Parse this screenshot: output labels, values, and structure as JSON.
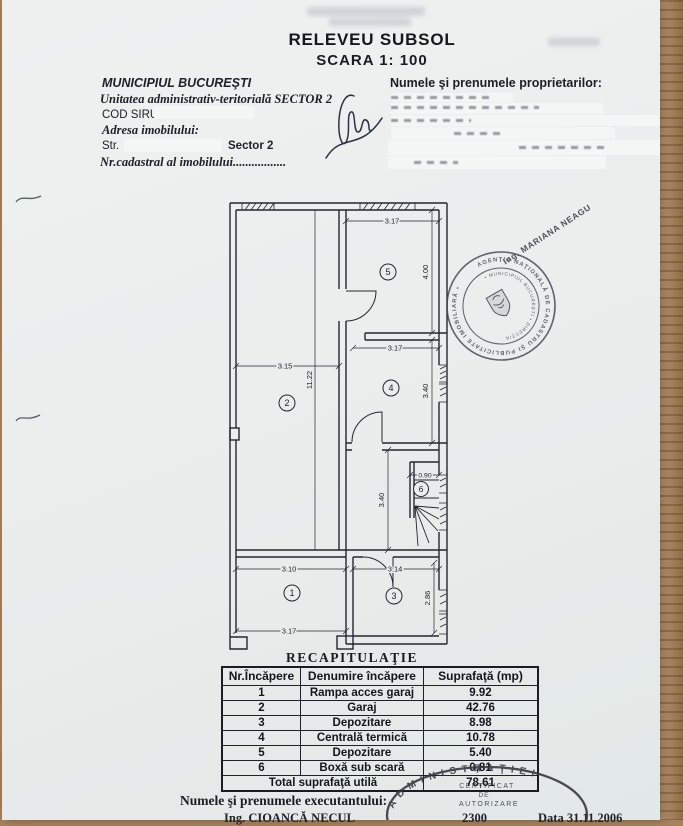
{
  "document": {
    "title": "RELEVEU SUBSOL",
    "scale": "SCARA 1: 100"
  },
  "property_info": {
    "municipality": "MUNICIPIUL BUCUREŞTI",
    "admin_unit": "Unitatea  administrativ-teritorială  SECTOR 2",
    "cod_siruta_label": "COD SIRUTA",
    "address_label": "Adresa imobilului:",
    "street_label": "Str.",
    "sector": "Sector 2",
    "cadastral_label": "Nr.cadastral al imobilului................."
  },
  "owners": {
    "label": "Numele şi prenumele proprietarilor:"
  },
  "plan": {
    "rooms": [
      "1",
      "2",
      "3",
      "4",
      "5",
      "6"
    ],
    "dims": {
      "room5_width": "3.17",
      "room5_height": "4.00",
      "room4_width": "3.17",
      "room4_height": "3.40",
      "room2_width": "3.15",
      "room2_height": "11.22",
      "room6_width": "0.90",
      "hall_height": "3.40",
      "room1_width_top": "3.10",
      "room1_width_bottom": "3.17",
      "room3_width": "3.14",
      "room3_height": "2.86"
    }
  },
  "stamps": {
    "surveyor": "Ing. MARIANA NEAGU",
    "round_outer": "AGENŢIA NAŢIONALĂ DE CADASTRU ŞI PUBLICITATE IMOBILIARĂ •",
    "round_inner": "• MUNICIPIUL BUCUREŞTI • DIRECŢIA",
    "oval_arc": "ADMINISTRAŢIEI",
    "oval_line1": "CERTIFICAT",
    "oval_line2": "DE",
    "oval_line3": "AUTORIZARE"
  },
  "recap": {
    "title": "RECAPITULAŢIE",
    "headers": [
      "Nr.Încăpere",
      "Denumire încăpere",
      "Suprafaţă (mp)"
    ],
    "rows": [
      {
        "nr": "1",
        "name": "Rampa acces garaj",
        "area": "9.92"
      },
      {
        "nr": "2",
        "name": "Garaj",
        "area": "42.76"
      },
      {
        "nr": "3",
        "name": "Depozitare",
        "area": "8.98"
      },
      {
        "nr": "4",
        "name": "Centrală termică",
        "area": "10.78"
      },
      {
        "nr": "5",
        "name": "Depozitare",
        "area": "5.40"
      },
      {
        "nr": "6",
        "name": "Boxă sub scară",
        "area": "0,81"
      }
    ],
    "total_label": "Total suprafaţă utilă",
    "total_value": "78,61"
  },
  "footer": {
    "executor_label": "Numele şi prenumele executantului:",
    "executor_name": "Ing. CIOANCĂ NECUL",
    "cert_no": "2300",
    "date": "Data  31.11.2006"
  }
}
